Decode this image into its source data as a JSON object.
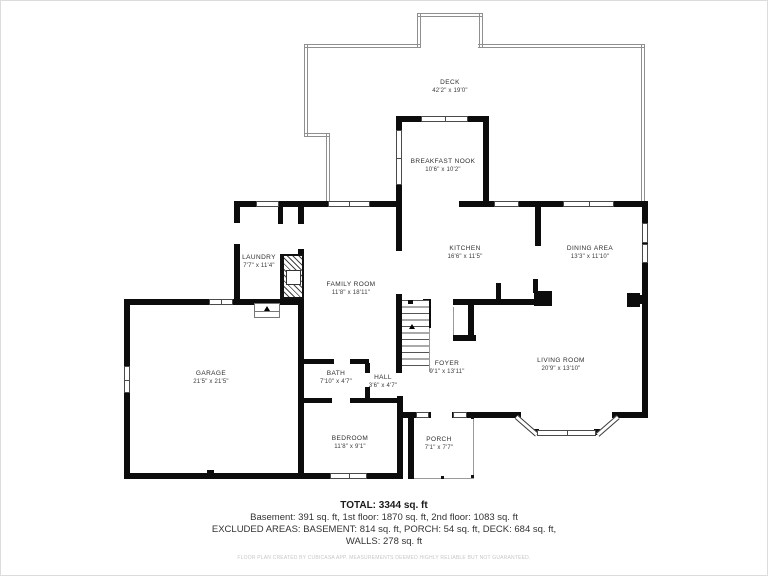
{
  "meta": {
    "title": "Floor plan - 1st floor",
    "background": "#ffffff",
    "wall_color": "#0c0c0c",
    "outline_color": "#8f8f8f"
  },
  "rooms": {
    "deck": {
      "label": "DECK",
      "dims": "42'2\" x 19'0\""
    },
    "breakfast_nook": {
      "label": "BREAKFAST NOOK",
      "dims": "10'6\" x 10'2\""
    },
    "laundry": {
      "label": "LAUNDRY",
      "dims": "7'7\" x 11'4\""
    },
    "family_room": {
      "label": "FAMILY ROOM",
      "dims": "11'8\" x 18'11\""
    },
    "kitchen": {
      "label": "KITCHEN",
      "dims": "16'6\" x 11'5\""
    },
    "dining_area": {
      "label": "DINING AREA",
      "dims": "13'3\" x 11'10\""
    },
    "garage": {
      "label": "GARAGE",
      "dims": "21'5\" x 21'5\""
    },
    "bath": {
      "label": "BATH",
      "dims": "7'10\" x 4'7\""
    },
    "hall": {
      "label": "HALL",
      "dims": "3'6\" x 4'7\""
    },
    "foyer": {
      "label": "FOYER",
      "dims": "9'1\" x 13'11\""
    },
    "living_room": {
      "label": "LIVING ROOM",
      "dims": "20'9\" x 13'10\""
    },
    "bedroom": {
      "label": "BEDROOM",
      "dims": "11'8\" x 9'1\""
    },
    "porch": {
      "label": "PORCH",
      "dims": "7'1\" x 7'7\""
    }
  },
  "summary": {
    "total": "TOTAL: 3344 sq. ft",
    "floors": "Basement: 391 sq. ft, 1st floor: 1870 sq. ft, 2nd floor: 1083 sq. ft",
    "excluded": "EXCLUDED AREAS: BASEMENT: 814 sq. ft, PORCH: 54 sq. ft, DECK: 684 sq. ft,",
    "walls": "WALLS: 278 sq. ft",
    "disclaimer": "FLOOR PLAN CREATED BY CUBICASA APP. MEASUREMENTS DEEMED HIGHLY RELIABLE BUT NOT GUARANTEED."
  }
}
